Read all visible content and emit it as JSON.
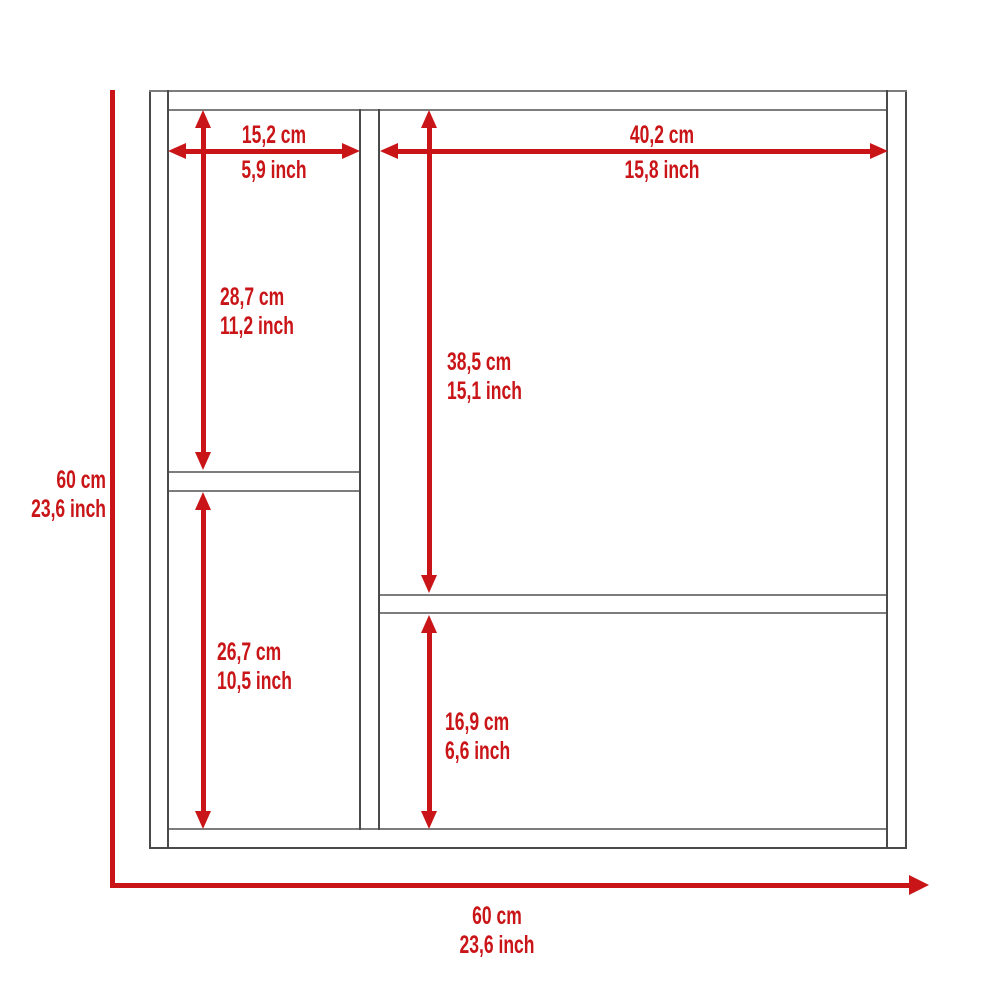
{
  "colors": {
    "accent_red": "#c91518",
    "outline_dark": "#4a4a4a",
    "outline_light": "#7d7d7d",
    "background": "#ffffff"
  },
  "labels": {
    "left_column_width": {
      "cm": "15,2 cm",
      "inch": "5,9 inch"
    },
    "right_column_width": {
      "cm": "40,2 cm",
      "inch": "15,8 inch"
    },
    "left_upper_height": {
      "cm": "28,7 cm",
      "inch": "11,2 inch"
    },
    "right_upper_height": {
      "cm": "38,5 cm",
      "inch": "15,1 inch"
    },
    "left_lower_height": {
      "cm": "26,7 cm",
      "inch": "10,5 inch"
    },
    "right_lower_height": {
      "cm": "16,9 cm",
      "inch": "6,6 inch"
    },
    "overall_height": {
      "cm": "60 cm",
      "inch": "23,6 inch"
    },
    "overall_width": {
      "cm": "60 cm",
      "inch": "23,6 inch"
    }
  }
}
